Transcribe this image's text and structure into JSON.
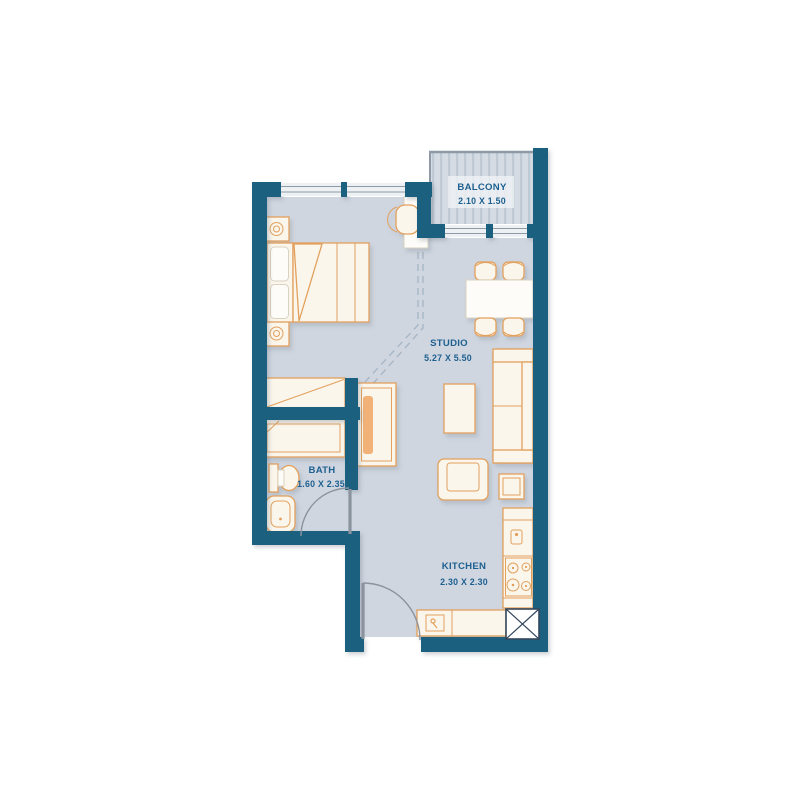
{
  "floor_plan": {
    "rooms": {
      "balcony": {
        "name": "BALCONY",
        "dimensions": "2.10 X 1.50"
      },
      "studio": {
        "name": "STUDIO",
        "dimensions": "5.27 X 5.50"
      },
      "bath": {
        "name": "BATH",
        "dimensions": "1.60 X 2.35"
      },
      "kitchen": {
        "name": "KITCHEN",
        "dimensions": "2.30 X 2.30"
      }
    },
    "colors": {
      "background": "#ffffff",
      "wall": "#1A6080",
      "floor": "#CFD6E0",
      "balcony_floor": "#D4DBE3",
      "balcony_stripe": "#BFC9D4",
      "window_glass": "#EEF1F4",
      "window_frame": "#8E9AA6",
      "furniture_outline": "#E2A05C",
      "furniture_fill": "#FBF6EC",
      "furniture_white": "#FDFCF8",
      "label_text": "#1E6090",
      "door_swing": "#8A939E",
      "dashed_line": "#A7B6C6",
      "shaft_line": "#33475C"
    },
    "symbols": [
      "double-bed",
      "pillows",
      "nightstand",
      "table-lamp",
      "closet",
      "wardrobe",
      "desk",
      "desk-chair",
      "dining-table",
      "dining-chair",
      "sofa",
      "coffee-table",
      "armchair",
      "side-table",
      "kitchen-counter",
      "kitchen-sink",
      "cooktop",
      "washbasin",
      "toilet",
      "bathtub",
      "shower",
      "door-swing",
      "window",
      "balcony-railing",
      "service-shaft"
    ]
  }
}
